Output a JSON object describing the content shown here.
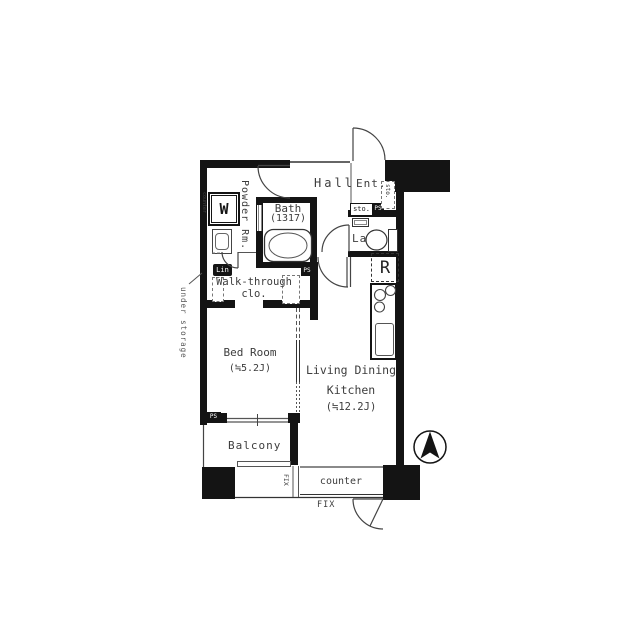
{
  "plan": {
    "title": "apartment-floor-plan",
    "rooms": {
      "powder_room": {
        "label": "Powder Rm."
      },
      "bath": {
        "label": "Bath",
        "size": "(1317)"
      },
      "hall": {
        "label": "Hall"
      },
      "entrance": {
        "label": "Ent."
      },
      "lavatory": {
        "label": "Lav"
      },
      "walk_through_closet": {
        "label_line1": "Walk-through",
        "label_line2": "clo."
      },
      "bedroom": {
        "label": "Bed Room",
        "size": "(≒5.2J)"
      },
      "ldk": {
        "label_line1": "Living Dining",
        "label_line2": "Kitchen",
        "size": "(≒12.2J)"
      },
      "balcony": {
        "label": "Balcony"
      }
    },
    "fixtures": {
      "washer": "W",
      "laundry_counter": "counter",
      "refrigerator": "R",
      "linen": "Lin",
      "storage_box": "sto.",
      "shoe_storage": "sto.",
      "pipe_space_entrance": "PS",
      "pipe_space_bath": "PS",
      "pipe_space_bedroom": "PS",
      "under_storage": "under storage",
      "window_fix_side": "FIX",
      "window_fix_bottom": "FIX",
      "counter": "counter"
    },
    "colors": {
      "wall": "#141414",
      "text": "#3d3d3d",
      "line": "#555555"
    }
  }
}
